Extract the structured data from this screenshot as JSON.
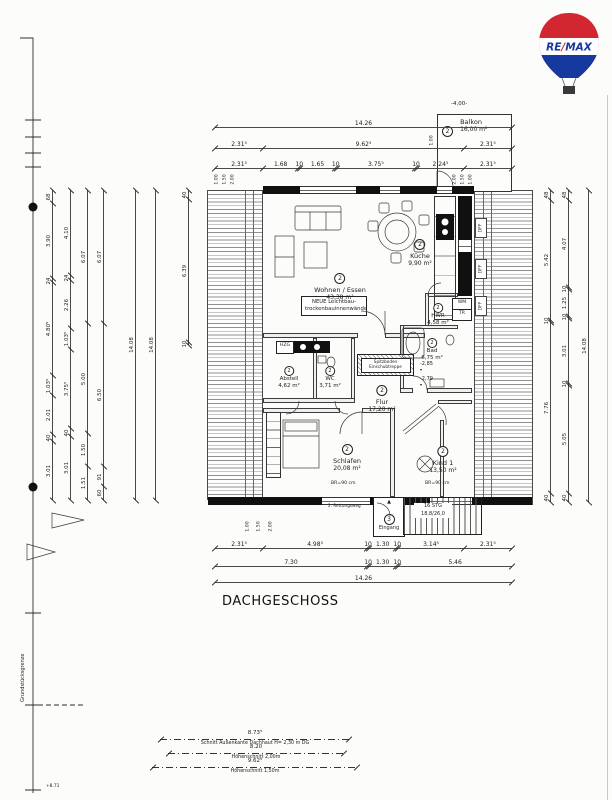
{
  "page": {
    "title": "DACHGESCHOSS",
    "boundary_label": "Grundstücksgrenze",
    "benchmark": "+8.71"
  },
  "logo": {
    "brand_left": "RE",
    "slash": "/",
    "brand_right": "MAX",
    "red": "#d22630",
    "blue": "#16399f"
  },
  "rooms": [
    {
      "no": "2",
      "name": "Balkon",
      "area": "16,00 m²"
    },
    {
      "no": "2",
      "name": "Wohnen / Essen",
      "area": "43,38 m²"
    },
    {
      "no": "2",
      "name": "Küche",
      "area": "9,90 m²"
    },
    {
      "no": "2",
      "name": "HWR",
      "area": "4,58 m²"
    },
    {
      "no": "2",
      "name": "Bad",
      "area": "6,75 m²"
    },
    {
      "no": "2",
      "name": "Flur",
      "area": "17,20 m²"
    },
    {
      "no": "2",
      "name": "Abstell",
      "area": "4,62 m²"
    },
    {
      "no": "2",
      "name": "WC",
      "area": "3,71 m²"
    },
    {
      "no": "2",
      "name": "Schlafen",
      "area": "20,08 m²"
    },
    {
      "no": "2",
      "name": "Kind 1",
      "area": "13,50 m²"
    },
    {
      "no": "3",
      "name": "Eingang",
      "area": ""
    }
  ],
  "annotations": {
    "balcony_offset": "-4,00-",
    "balcony_inset": "1.00",
    "note_line1": "NEUE Leichtbau-",
    "note_line2": "trockenbauinnenwände",
    "hatch_line1": "Spitzboden",
    "hatch_line2": "Einschubtreppe",
    "level_a": "-2,85",
    "level_b": "-2,79",
    "stairs_line1": "16 STG",
    "stairs_line2": "18,8/26,0",
    "escape_route": "2. Rettungsweg",
    "sill_height": "BR=90 cm",
    "wm": "WM",
    "tr": "TR",
    "dff": "DFF",
    "hzg": "HZG",
    "entrance_arrow": "▲"
  },
  "dims": {
    "top": [
      [
        "14.26"
      ],
      [
        "2.31⁵",
        "9.62⁵",
        "2.31⁵"
      ],
      [
        "2.31⁵",
        "1.68",
        "10",
        "1.65",
        "10",
        "3.75⁵",
        "10",
        "2.24⁵",
        "2.31⁵"
      ]
    ],
    "bottom": [
      [
        "2.31⁵",
        "4.98⁵",
        "10",
        "1.30",
        "10",
        "3.14⁵",
        "2.31⁵"
      ],
      [
        "7.30",
        "10",
        "1.30",
        "10",
        "5.46"
      ],
      [
        "14.26"
      ]
    ],
    "left": [
      [
        "68",
        "3.90",
        "24",
        "4.80⁵",
        "1.03⁵",
        "2.01",
        "40",
        "3.01"
      ],
      [
        "4.10",
        "24",
        "2.26",
        "1.03⁵",
        "3.75⁵",
        "40",
        "3.01"
      ],
      [
        "6.07",
        "5.00",
        "1.50",
        "1.51"
      ],
      [
        "6.07",
        "6.50",
        "91",
        "60"
      ],
      [
        "14.08"
      ],
      [
        "14.08"
      ],
      [
        "40",
        "6.39",
        "10"
      ]
    ],
    "right": [
      [
        "48",
        "5.42",
        "10",
        "7.76",
        "40"
      ],
      [
        "48",
        "4.07",
        "10",
        "1.25",
        "10",
        "3.01",
        "10",
        "5.05",
        "40"
      ],
      [
        "14.08"
      ]
    ],
    "height_marks_left": [
      "1.00",
      "1.50",
      "2.00"
    ],
    "height_marks_right": [
      "2.00",
      "1.50",
      "1.00"
    ],
    "height_marks_bottom": [
      "1.00",
      "1.50",
      "2.00"
    ],
    "sections": [
      {
        "value": "8.73⁵",
        "label": "Schnitt Außenkante Dachhaut H= 2,30 m DG"
      },
      {
        "value": "8.20",
        "label": "Höhenschnitt 2,00m"
      },
      {
        "value": "9.62⁵",
        "label": "Höhenschnitt 1,50m"
      }
    ]
  }
}
